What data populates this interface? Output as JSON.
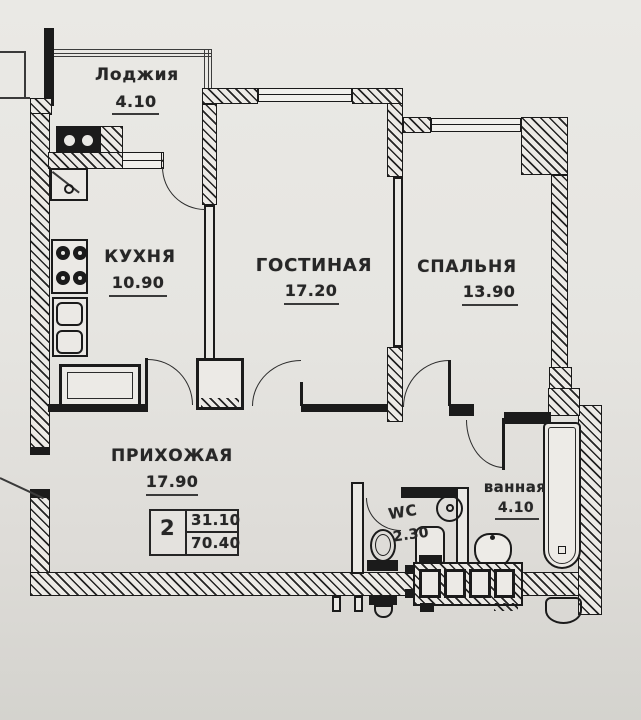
{
  "plan": {
    "rooms": [
      {
        "id": "loggia",
        "label": "Лоджия",
        "area": "4.10"
      },
      {
        "id": "kitchen",
        "label": "КУХНЯ",
        "area": "10.90"
      },
      {
        "id": "living",
        "label": "ГОСТИНАЯ",
        "area": "17.20"
      },
      {
        "id": "bedroom",
        "label": "СПАЛЬНЯ",
        "area": "13.90"
      },
      {
        "id": "hall",
        "label": "ПРИХОЖАЯ",
        "area": "17.90"
      },
      {
        "id": "wc",
        "label": "WC",
        "area": "2.30"
      },
      {
        "id": "bath",
        "label": "ванная",
        "area": "4.10"
      }
    ],
    "stamp": {
      "rooms_count": "2",
      "living_area": "31.10",
      "total_area": "70.40"
    },
    "colors": {
      "paper": "#e6e5e1",
      "ink": "#1b1b1b"
    },
    "fixtures": [
      "cooktop-2-burner-icon",
      "stove-4-burner-icon",
      "kitchen-sink-icon",
      "counter-icon",
      "toilet-icon",
      "washing-machine-icon",
      "corner-washbasin-icon",
      "bathtub-icon",
      "washbasin-icon",
      "vent-shaft-icon"
    ]
  }
}
